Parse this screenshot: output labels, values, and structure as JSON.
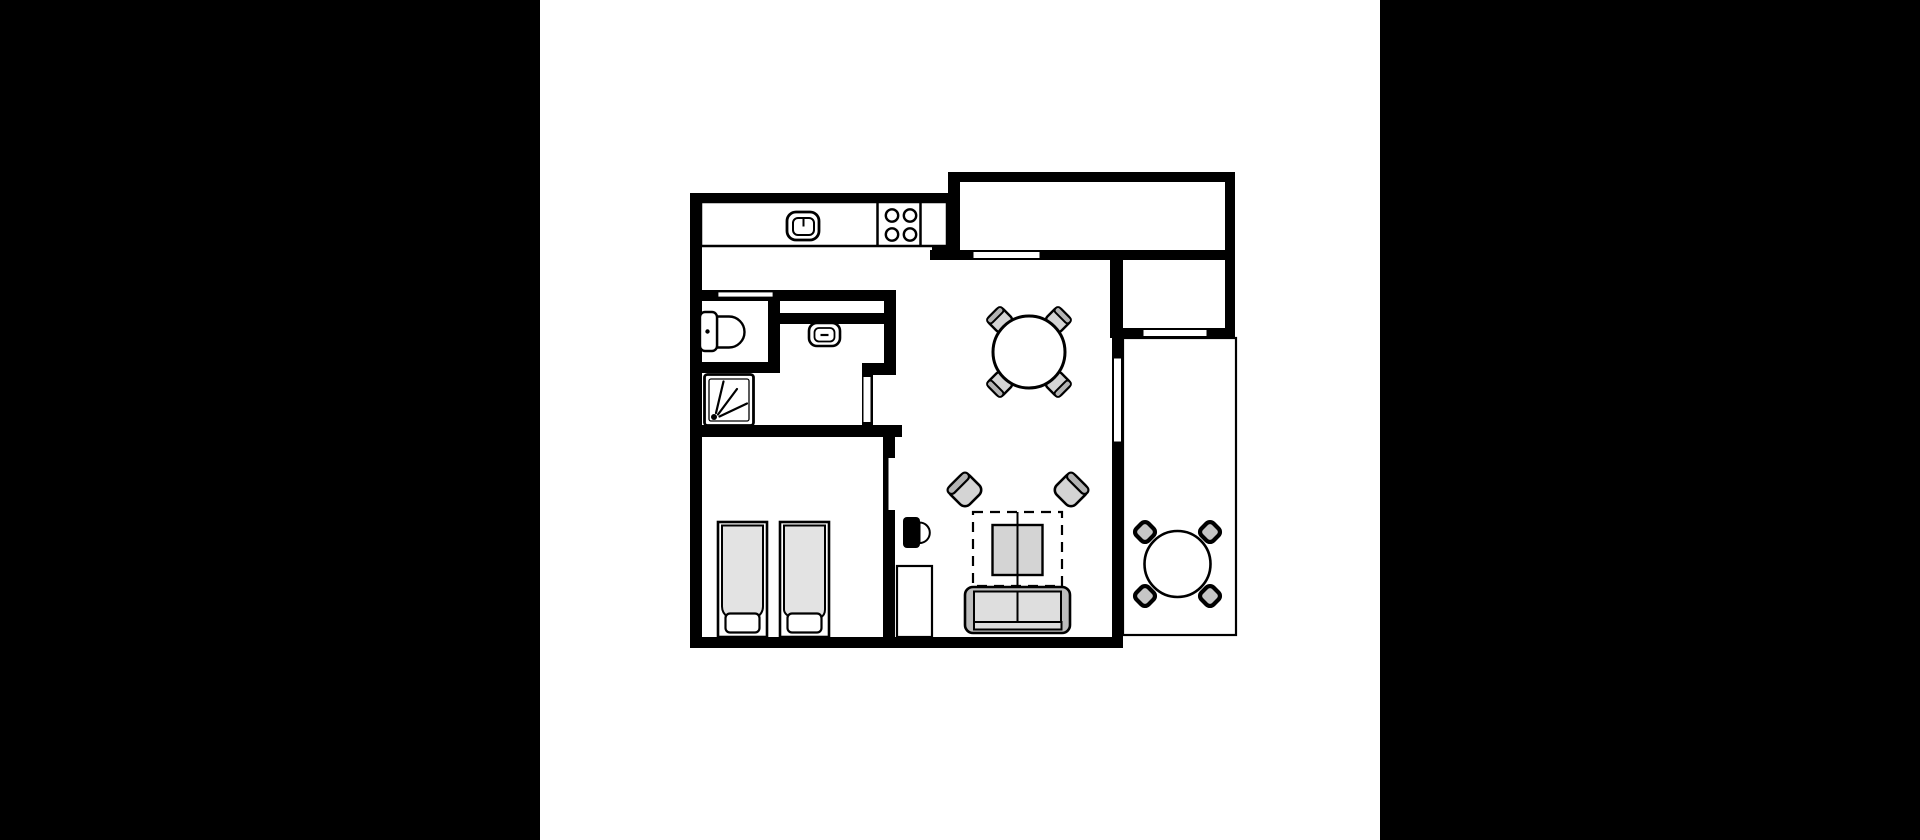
{
  "meta": {
    "description": "apartment-floor-plan",
    "background_color": "#000000",
    "floor_color": "#ffffff",
    "wall_color": "#000000",
    "furniture_gray": "#d4d4d4",
    "band_gray": "#b3b3b3",
    "sofa_gray": "#bdbdbd",
    "cushion_gray": "#dedede",
    "duvet_gray": "#e3e3e3",
    "balcony_chair_gray": "#c6c6c6"
  },
  "elements": [
    {
      "name": "backdrop",
      "kind": "rect",
      "x": 0,
      "y": 0,
      "w": 1920,
      "h": 840,
      "fill": "#000000"
    },
    {
      "name": "floor-panel",
      "kind": "rect",
      "x": 540,
      "y": 0,
      "w": 840,
      "h": 840,
      "fill": "#ffffff"
    },
    {
      "name": "wall-left",
      "kind": "rect",
      "x": 690,
      "y": 193,
      "w": 12,
      "h": 455,
      "fill": "#000000"
    },
    {
      "name": "wall-kitchen-top",
      "kind": "rect",
      "x": 690,
      "y": 193,
      "w": 270,
      "h": 10,
      "fill": "#000000"
    },
    {
      "name": "wall-entry-top",
      "kind": "rect",
      "x": 950,
      "y": 172,
      "w": 285,
      "h": 10,
      "fill": "#000000"
    },
    {
      "name": "wall-entry-left",
      "kind": "rect",
      "x": 948,
      "y": 172,
      "w": 12,
      "h": 88,
      "fill": "#000000"
    },
    {
      "name": "wall-entry-bottom",
      "kind": "rect",
      "x": 930,
      "y": 250,
      "w": 305,
      "h": 10,
      "fill": "#000000"
    },
    {
      "name": "wall-counter-return",
      "kind": "rect",
      "x": 932,
      "y": 240,
      "w": 28,
      "h": 10,
      "fill": "#000000"
    },
    {
      "name": "wall-upper-right",
      "kind": "rect",
      "x": 1225,
      "y": 172,
      "w": 10,
      "h": 166,
      "fill": "#000000"
    },
    {
      "name": "wall-storage-left",
      "kind": "rect",
      "x": 1110,
      "y": 250,
      "w": 12,
      "h": 88,
      "fill": "#000000"
    },
    {
      "name": "wall-storage-bottom",
      "kind": "rect",
      "x": 1110,
      "y": 328,
      "w": 125,
      "h": 10,
      "fill": "#000000"
    },
    {
      "name": "wall-living-right",
      "kind": "rect",
      "x": 1112,
      "y": 250,
      "w": 11,
      "h": 398,
      "fill": "#000000"
    },
    {
      "name": "wall-bottom",
      "kind": "rect",
      "x": 690,
      "y": 637,
      "w": 433,
      "h": 11,
      "fill": "#000000"
    },
    {
      "name": "wall-bath-top",
      "kind": "rect",
      "x": 690,
      "y": 290,
      "w": 206,
      "h": 11,
      "fill": "#000000"
    },
    {
      "name": "wall-wc-right",
      "kind": "rect",
      "x": 768,
      "y": 297,
      "w": 12,
      "h": 65,
      "fill": "#000000"
    },
    {
      "name": "wall-wc-bottom",
      "kind": "rect",
      "x": 690,
      "y": 362,
      "w": 90,
      "h": 11,
      "fill": "#000000"
    },
    {
      "name": "wall-bath-inner-top",
      "kind": "rect",
      "x": 780,
      "y": 313,
      "w": 116,
      "h": 11,
      "fill": "#000000"
    },
    {
      "name": "wall-bath-right",
      "kind": "rect",
      "x": 884,
      "y": 301,
      "w": 12,
      "h": 62,
      "fill": "#000000"
    },
    {
      "name": "wall-bath-jog",
      "kind": "rect",
      "x": 862,
      "y": 363,
      "w": 34,
      "h": 12,
      "fill": "#000000"
    },
    {
      "name": "wall-bath-door",
      "kind": "rect",
      "x": 862,
      "y": 375,
      "w": 11,
      "h": 50,
      "fill": "#000000"
    },
    {
      "name": "wall-bath-bottom",
      "kind": "rect",
      "x": 690,
      "y": 425,
      "w": 212,
      "h": 12,
      "fill": "#000000"
    },
    {
      "name": "wall-bedroom-right",
      "kind": "rect",
      "x": 883,
      "y": 437,
      "w": 12,
      "h": 200,
      "fill": "#000000"
    },
    {
      "name": "entry-door-opening",
      "kind": "rect",
      "x": 973,
      "y": 251.5,
      "w": 67,
      "h": 7,
      "fill": "#ffffff",
      "stroke": "#000000",
      "sw": 1
    },
    {
      "name": "storage-window",
      "kind": "rect",
      "x": 1143,
      "y": 329.5,
      "w": 64,
      "h": 7,
      "fill": "#ffffff",
      "stroke": "#000000",
      "sw": 1
    },
    {
      "name": "living-window",
      "kind": "rect",
      "x": 1113.5,
      "y": 358,
      "w": 8,
      "h": 84,
      "fill": "#ffffff",
      "stroke": "#000000",
      "sw": 1
    },
    {
      "name": "wc-vent-window",
      "kind": "rect",
      "x": 718,
      "y": 292,
      "w": 55,
      "h": 5,
      "fill": "#ffffff",
      "stroke": "#000000",
      "sw": 0.8
    },
    {
      "name": "bath-door-leaf",
      "kind": "rect",
      "x": 863.5,
      "y": 377,
      "w": 7,
      "h": 45,
      "fill": "#ffffff"
    },
    {
      "name": "bedroom-door-leaf",
      "kind": "rect",
      "x": 888.5,
      "y": 458,
      "w": 6.5,
      "h": 52,
      "fill": "#ffffff"
    },
    {
      "name": "balcony-outline",
      "kind": "rect",
      "x": 1123,
      "y": 338,
      "w": 113,
      "h": 297,
      "fill": "none",
      "stroke": "#000000",
      "sw": 2.2
    },
    {
      "name": "kitchen-counter",
      "kind": "rect",
      "x": 701,
      "y": 202,
      "w": 246,
      "h": 44,
      "fill": "#ffffff",
      "stroke": "#000000",
      "sw": 2.5
    },
    {
      "name": "stove-divider-left",
      "kind": "line",
      "x1": 877.5,
      "y1": 203,
      "x2": 877.5,
      "y2": 245,
      "stroke": "#000000",
      "sw": 2.5
    },
    {
      "name": "stove-divider-right",
      "kind": "line",
      "x1": 920.5,
      "y1": 203,
      "x2": 920.5,
      "y2": 245,
      "stroke": "#000000",
      "sw": 2.5
    },
    {
      "name": "burner-top-left",
      "kind": "circle",
      "cx": 892,
      "cy": 215.5,
      "r": 6.2,
      "fill": "#ffffff",
      "stroke": "#000000",
      "sw": 2.4
    },
    {
      "name": "burner-top-right",
      "kind": "circle",
      "cx": 910,
      "cy": 215.5,
      "r": 6.2,
      "fill": "#ffffff",
      "stroke": "#000000",
      "sw": 2.4
    },
    {
      "name": "burner-bottom-left",
      "kind": "circle",
      "cx": 892,
      "cy": 234.5,
      "r": 6.2,
      "fill": "#ffffff",
      "stroke": "#000000",
      "sw": 2.4
    },
    {
      "name": "burner-bottom-right",
      "kind": "circle",
      "cx": 910,
      "cy": 234.5,
      "r": 6.2,
      "fill": "#ffffff",
      "stroke": "#000000",
      "sw": 2.4
    },
    {
      "name": "kitchen-sink-outer",
      "kind": "rect",
      "x": 787,
      "y": 212,
      "w": 32,
      "h": 28,
      "rx": 9,
      "fill": "#ffffff",
      "stroke": "#000000",
      "sw": 2.8
    },
    {
      "name": "kitchen-sink-inner",
      "kind": "rect",
      "x": 793,
      "y": 218,
      "w": 21,
      "h": 17,
      "rx": 5,
      "fill": "#ffffff",
      "stroke": "#000000",
      "sw": 2
    },
    {
      "name": "kitchen-sink-tick",
      "kind": "line",
      "x1": 803.5,
      "y1": 218.5,
      "x2": 803.5,
      "y2": 226.5,
      "stroke": "#000000",
      "sw": 2
    },
    {
      "name": "toilet-bowl",
      "kind": "path",
      "d": "M717,316.5 L729,316.5 A15.5,15.5 0 0 1 729,347.5 L717,347.5 Z",
      "fill": "#ffffff",
      "stroke": "#000000",
      "sw": 2.4
    },
    {
      "name": "toilet-tank",
      "kind": "rect",
      "x": 700,
      "y": 312,
      "w": 17,
      "h": 39,
      "rx": 5,
      "fill": "#ffffff",
      "stroke": "#000000",
      "sw": 2.4
    },
    {
      "name": "toilet-flush-dot",
      "kind": "circle",
      "cx": 707.5,
      "cy": 331.5,
      "r": 2.2,
      "fill": "#000000"
    },
    {
      "name": "bath-basin-outer",
      "kind": "rect",
      "x": 809,
      "y": 323,
      "w": 31,
      "h": 23,
      "rx": 8,
      "fill": "#ffffff",
      "stroke": "#000000",
      "sw": 2.6
    },
    {
      "name": "bath-basin-inner",
      "kind": "rect",
      "x": 814.5,
      "y": 328,
      "w": 20,
      "h": 13.5,
      "rx": 4.5,
      "fill": "#ffffff",
      "stroke": "#000000",
      "sw": 1.8
    },
    {
      "name": "bath-basin-dash",
      "kind": "line",
      "x1": 820.5,
      "y1": 335,
      "x2": 828.5,
      "y2": 335,
      "stroke": "#000000",
      "sw": 2.2
    },
    {
      "name": "shower-tray-outer",
      "kind": "rect",
      "x": 704.5,
      "y": 374.5,
      "w": 49,
      "h": 51,
      "rx": 3,
      "fill": "#ffffff",
      "stroke": "#000000",
      "sw": 2.8
    },
    {
      "name": "shower-tray-inner",
      "kind": "rect",
      "x": 709,
      "y": 379,
      "w": 40,
      "h": 42,
      "rx": 2,
      "fill": "none",
      "stroke": "#000000",
      "sw": 1.3
    },
    {
      "name": "shower-drain-dot",
      "kind": "circle",
      "cx": 714,
      "cy": 417,
      "r": 3,
      "fill": "#000000"
    },
    {
      "name": "shower-spray-1",
      "kind": "line",
      "x1": 716,
      "y1": 413,
      "x2": 723.5,
      "y2": 381.5,
      "stroke": "#000000",
      "sw": 2.2,
      "cap": "round"
    },
    {
      "name": "shower-spray-2",
      "kind": "line",
      "x1": 718,
      "y1": 414.5,
      "x2": 737,
      "y2": 389,
      "stroke": "#000000",
      "sw": 2.2,
      "cap": "round"
    },
    {
      "name": "shower-spray-3",
      "kind": "line",
      "x1": 719.5,
      "y1": 416.5,
      "x2": 747,
      "y2": 403.5,
      "stroke": "#000000",
      "sw": 2.2,
      "cap": "round"
    },
    {
      "name": "bed-1-frame",
      "kind": "rect",
      "x": 718,
      "y": 522,
      "w": 49,
      "h": 115,
      "fill": "#ffffff",
      "stroke": "#000000",
      "sw": 2.6
    },
    {
      "name": "bed-1-duvet",
      "kind": "path",
      "d": "M722,525.5 h41 v81 c0,9 -9,14.5 -20.5,14.5 c-11.5,0 -20.5,-5.5 -20.5,-14.5 Z",
      "fill": "#e3e3e3",
      "stroke": "#000000",
      "sw": 2
    },
    {
      "name": "bed-1-pillow",
      "kind": "rect",
      "x": 725.5,
      "y": 613.5,
      "w": 34,
      "h": 19,
      "rx": 4.5,
      "fill": "#ffffff",
      "stroke": "#000000",
      "sw": 2.2
    },
    {
      "name": "bed-2-frame",
      "kind": "rect",
      "x": 780,
      "y": 522,
      "w": 49,
      "h": 115,
      "fill": "#ffffff",
      "stroke": "#000000",
      "sw": 2.6
    },
    {
      "name": "bed-2-duvet",
      "kind": "path",
      "d": "M784,525.5 h41 v84 c0,8 -8,11 -13,6.5 c-3,-2.5 -6,-2.5 -8.5,0.5 c-2.5,3 -6,4 -9.5,2.5 c-6,-2.5 -10,-5.5 -10,-9.5 Z",
      "fill": "#e3e3e3",
      "stroke": "#000000",
      "sw": 2
    },
    {
      "name": "bed-2-pillow",
      "kind": "rect",
      "x": 787.5,
      "y": 613.5,
      "w": 34,
      "h": 19,
      "rx": 4.5,
      "fill": "#ffffff",
      "stroke": "#000000",
      "sw": 2.2
    },
    {
      "name": "door-handle-pad",
      "kind": "rect",
      "x": 903,
      "y": 517,
      "w": 17,
      "h": 31,
      "rx": 4,
      "fill": "#000000"
    },
    {
      "name": "door-handle-knob",
      "kind": "path",
      "d": "M919.5,522.5 a10.3,10.3 0 0 1 0,20.6 Z",
      "fill": "#ffffff",
      "stroke": "#000000",
      "sw": 2
    },
    {
      "name": "hall-closet",
      "kind": "rect",
      "x": 897,
      "y": 566,
      "w": 35,
      "h": 71,
      "fill": "#ffffff",
      "stroke": "#000000",
      "sw": 2.2
    },
    {
      "name": "rug-dashed",
      "kind": "rect",
      "x": 973,
      "y": 512,
      "w": 89,
      "h": 74,
      "fill": "none",
      "stroke": "#000000",
      "sw": 2.2,
      "dash": "10 7"
    },
    {
      "name": "coffee-table",
      "kind": "rect",
      "x": 992.5,
      "y": 525,
      "w": 50,
      "h": 50,
      "fill": "#d4d4d4",
      "stroke": "#000000",
      "sw": 2.4
    },
    {
      "name": "rug-center-line",
      "kind": "line",
      "x1": 1017.5,
      "y1": 512,
      "x2": 1017.5,
      "y2": 589,
      "stroke": "#000000",
      "sw": 2
    },
    {
      "name": "armchair-left-seat",
      "kind": "rect",
      "x": 951.5,
      "y": 476.5,
      "w": 27,
      "h": 27,
      "rx": 7,
      "fill": "#d4d4d4",
      "stroke": "#000000",
      "sw": 2.6,
      "rot": [
        -45,
        965,
        490
      ]
    },
    {
      "name": "armchair-left-back",
      "kind": "rect",
      "x": 951.5,
      "y": 476.5,
      "w": 27,
      "h": 8,
      "rx": 4,
      "fill": "#b3b3b3",
      "stroke": "#000000",
      "sw": 2.2,
      "rot": [
        -45,
        965,
        490
      ]
    },
    {
      "name": "armchair-right-seat",
      "kind": "rect",
      "x": 1057.5,
      "y": 476.5,
      "w": 27,
      "h": 27,
      "rx": 7,
      "fill": "#d4d4d4",
      "stroke": "#000000",
      "sw": 2.6,
      "rot": [
        -45,
        1071,
        490
      ]
    },
    {
      "name": "armchair-right-back",
      "kind": "rect",
      "x": 1076.5,
      "y": 476.5,
      "w": 8,
      "h": 27,
      "rx": 4,
      "fill": "#b3b3b3",
      "stroke": "#000000",
      "sw": 2.2,
      "rot": [
        -45,
        1071,
        490
      ]
    },
    {
      "name": "sofa-frame",
      "kind": "rect",
      "x": 965,
      "y": 587,
      "w": 105,
      "h": 46,
      "rx": 8,
      "fill": "#bdbdbd",
      "stroke": "#000000",
      "sw": 2.6
    },
    {
      "name": "sofa-cushion-left",
      "kind": "rect",
      "x": 974,
      "y": 591.5,
      "w": 43.5,
      "h": 30.5,
      "fill": "#dedede",
      "stroke": "#000000",
      "sw": 2
    },
    {
      "name": "sofa-cushion-right",
      "kind": "rect",
      "x": 1017.5,
      "y": 591.5,
      "w": 43.5,
      "h": 30.5,
      "fill": "#dedede",
      "stroke": "#000000",
      "sw": 2
    },
    {
      "name": "sofa-front-edge",
      "kind": "rect",
      "x": 974,
      "y": 622,
      "w": 87.5,
      "h": 7.5,
      "fill": "#dedede",
      "stroke": "#000000",
      "sw": 2
    },
    {
      "name": "dining-chair-nw-seat",
      "kind": "rect",
      "x": 990,
      "y": 310,
      "w": 20,
      "h": 20,
      "rx": 5,
      "fill": "#d4d4d4",
      "stroke": "#000000",
      "sw": 2.4,
      "rot": [
        -45,
        1000,
        320
      ]
    },
    {
      "name": "dining-chair-nw-back",
      "kind": "rect",
      "x": 990,
      "y": 310,
      "w": 20,
      "h": 6.5,
      "rx": 3,
      "fill": "#b3b3b3",
      "stroke": "#000000",
      "sw": 2,
      "rot": [
        -45,
        1000,
        320
      ]
    },
    {
      "name": "dining-chair-ne-seat",
      "kind": "rect",
      "x": 1048,
      "y": 310,
      "w": 20,
      "h": 20,
      "rx": 5,
      "fill": "#d4d4d4",
      "stroke": "#000000",
      "sw": 2.4,
      "rot": [
        -45,
        1058,
        320
      ]
    },
    {
      "name": "dining-chair-ne-back",
      "kind": "rect",
      "x": 1061.5,
      "y": 310,
      "w": 6.5,
      "h": 20,
      "rx": 3,
      "fill": "#b3b3b3",
      "stroke": "#000000",
      "sw": 2,
      "rot": [
        -45,
        1058,
        320
      ]
    },
    {
      "name": "dining-chair-sw-seat",
      "kind": "rect",
      "x": 990,
      "y": 374,
      "w": 20,
      "h": 20,
      "rx": 5,
      "fill": "#d4d4d4",
      "stroke": "#000000",
      "sw": 2.4,
      "rot": [
        -45,
        1000,
        384
      ]
    },
    {
      "name": "dining-chair-sw-back",
      "kind": "rect",
      "x": 990,
      "y": 374,
      "w": 6.5,
      "h": 20,
      "rx": 3,
      "fill": "#b3b3b3",
      "stroke": "#000000",
      "sw": 2,
      "rot": [
        -45,
        1000,
        384
      ]
    },
    {
      "name": "dining-chair-se-seat",
      "kind": "rect",
      "x": 1048,
      "y": 374,
      "w": 20,
      "h": 20,
      "rx": 5,
      "fill": "#d4d4d4",
      "stroke": "#000000",
      "sw": 2.4,
      "rot": [
        -45,
        1058,
        384
      ]
    },
    {
      "name": "dining-chair-se-back",
      "kind": "rect",
      "x": 1048,
      "y": 387.5,
      "w": 20,
      "h": 6.5,
      "rx": 3,
      "fill": "#b3b3b3",
      "stroke": "#000000",
      "sw": 2,
      "rot": [
        -45,
        1058,
        384
      ]
    },
    {
      "name": "dining-table",
      "kind": "circle",
      "cx": 1029,
      "cy": 352,
      "r": 36,
      "fill": "#ffffff",
      "stroke": "#000000",
      "sw": 3
    },
    {
      "name": "balcony-chair-nw",
      "kind": "rect",
      "x": 1136.5,
      "y": 523.5,
      "w": 17,
      "h": 17,
      "rx": 5,
      "fill": "#c6c6c6",
      "stroke": "#000000",
      "sw": 4.2,
      "rot": [
        -45,
        1145,
        532
      ]
    },
    {
      "name": "balcony-chair-ne",
      "kind": "rect",
      "x": 1201.5,
      "y": 523.5,
      "w": 17,
      "h": 17,
      "rx": 5,
      "fill": "#c6c6c6",
      "stroke": "#000000",
      "sw": 4.2,
      "rot": [
        -45,
        1210,
        532
      ]
    },
    {
      "name": "balcony-chair-sw",
      "kind": "rect",
      "x": 1136.5,
      "y": 587.5,
      "w": 17,
      "h": 17,
      "rx": 5,
      "fill": "#c6c6c6",
      "stroke": "#000000",
      "sw": 4.2,
      "rot": [
        -45,
        1145,
        596
      ]
    },
    {
      "name": "balcony-chair-se",
      "kind": "rect",
      "x": 1201.5,
      "y": 587.5,
      "w": 17,
      "h": 17,
      "rx": 5,
      "fill": "#c6c6c6",
      "stroke": "#000000",
      "sw": 4.2,
      "rot": [
        -45,
        1210,
        596
      ]
    },
    {
      "name": "balcony-table",
      "kind": "circle",
      "cx": 1177.5,
      "cy": 564,
      "r": 33,
      "fill": "#ffffff",
      "stroke": "#000000",
      "sw": 2.6
    }
  ]
}
